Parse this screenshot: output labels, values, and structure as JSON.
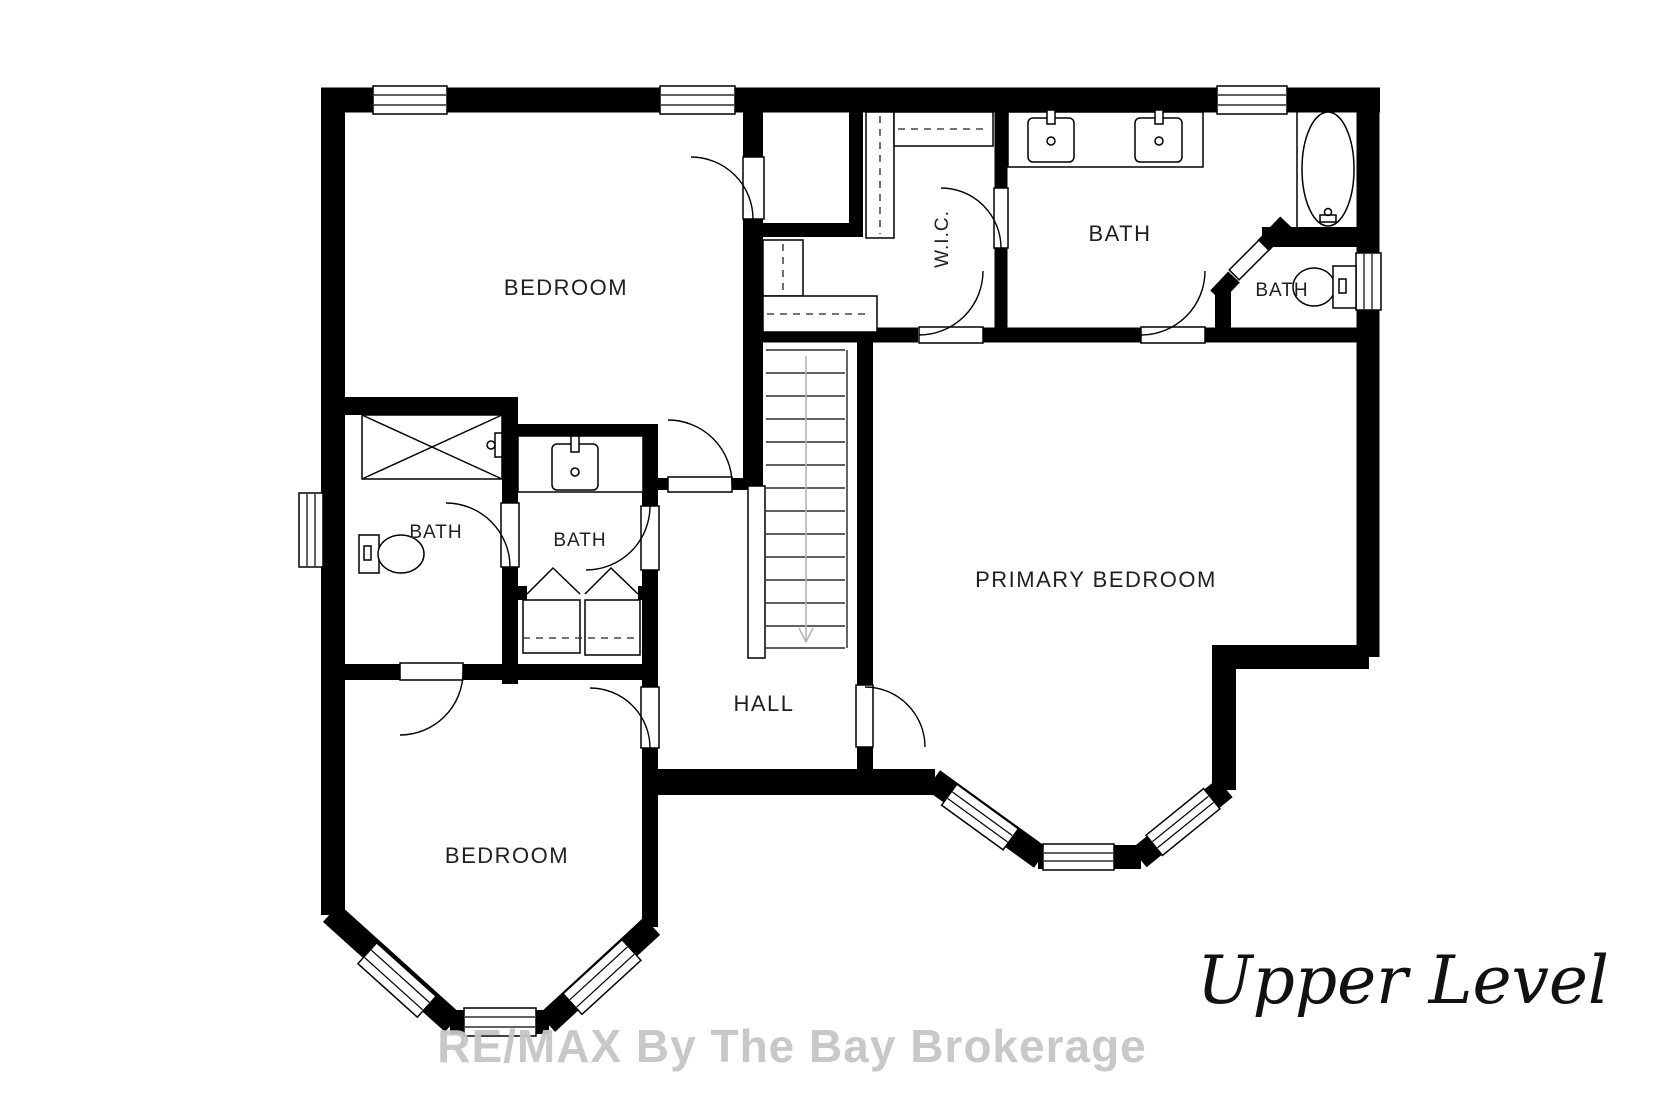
{
  "plan": {
    "rooms": {
      "bedroom_top": "BEDROOM",
      "wic": "W.I.C.",
      "bath_main": "BATH",
      "bath_wc": "BATH",
      "bath_left": "BATH",
      "bath_mid": "BATH",
      "hall": "HALL",
      "primary_bedroom": "PRIMARY BEDROOM",
      "bedroom_bottom": "BEDROOM"
    },
    "level_label": "Upper Level",
    "watermark": "RE/MAX By The Bay Brokerage",
    "colors": {
      "wall": "#000000",
      "background": "#ffffff",
      "label": "#1f1f1f",
      "watermark": "#c6c6c6",
      "stair_arrow": "#b5b5b5"
    }
  }
}
